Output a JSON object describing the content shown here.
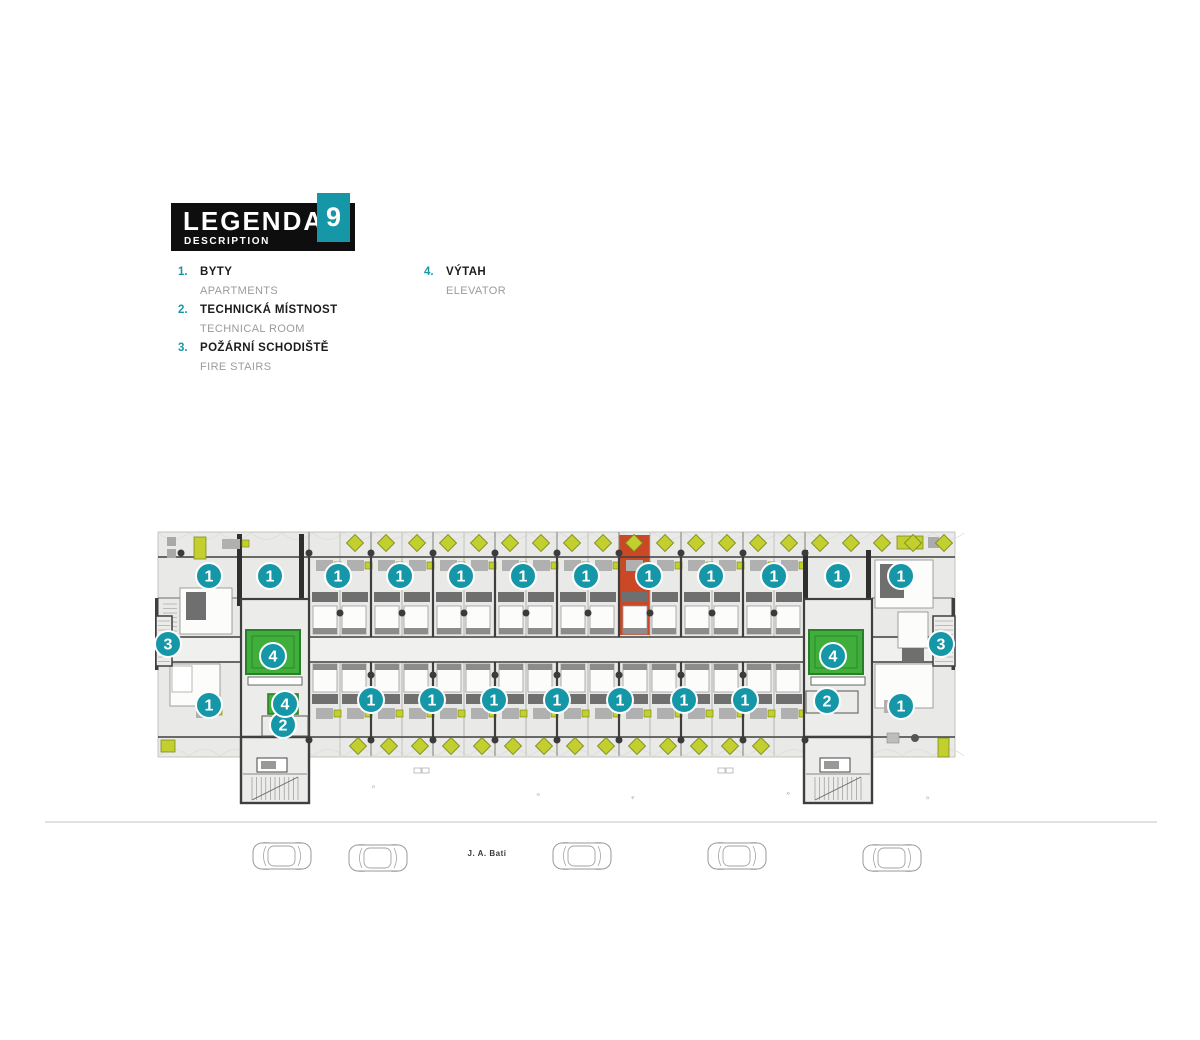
{
  "legend": {
    "title": "LEGENDA",
    "subtitle": "DESCRIPTION",
    "floor_number": "9",
    "items": [
      {
        "num": "1.",
        "label_cs": "BYTY",
        "label_en": "APARTMENTS"
      },
      {
        "num": "2.",
        "label_cs": "TECHNICKÁ MÍSTNOST",
        "label_en": "TECHNICAL ROOM"
      },
      {
        "num": "3.",
        "label_cs": "POŽÁRNÍ SCHODIŠTĚ",
        "label_en": "FIRE STAIRS"
      },
      {
        "num": "4.",
        "label_cs": "VÝTAH",
        "label_en": "ELEVATOR"
      }
    ]
  },
  "plan": {
    "colors": {
      "teal": "#1697a8",
      "green": "#3fae3b",
      "green_dark": "#2c7f2a",
      "red": "#cb4826",
      "furniture_yellow": "#c3cf2e",
      "furniture_yellow_dark": "#7d8d1f",
      "wall": "#3f3f3f",
      "floor": "#e9e9e7",
      "room": "#fcfcfb",
      "gray_block": "#6f6f6f",
      "gray_desk": "#b0b0b0",
      "road": "#cfcfcd",
      "car_outline": "#9a9a9a"
    },
    "markers": [
      {
        "n": "1",
        "x": 209,
        "y": 576
      },
      {
        "n": "1",
        "x": 270,
        "y": 576
      },
      {
        "n": "1",
        "x": 338,
        "y": 576
      },
      {
        "n": "1",
        "x": 400,
        "y": 576
      },
      {
        "n": "1",
        "x": 461,
        "y": 576
      },
      {
        "n": "1",
        "x": 523,
        "y": 576
      },
      {
        "n": "1",
        "x": 586,
        "y": 576
      },
      {
        "n": "1",
        "x": 649,
        "y": 576
      },
      {
        "n": "1",
        "x": 711,
        "y": 576
      },
      {
        "n": "1",
        "x": 774,
        "y": 576
      },
      {
        "n": "1",
        "x": 838,
        "y": 576
      },
      {
        "n": "1",
        "x": 901,
        "y": 576
      },
      {
        "n": "1",
        "x": 209,
        "y": 705
      },
      {
        "n": "1",
        "x": 371,
        "y": 700
      },
      {
        "n": "1",
        "x": 432,
        "y": 700
      },
      {
        "n": "1",
        "x": 494,
        "y": 700
      },
      {
        "n": "1",
        "x": 557,
        "y": 700
      },
      {
        "n": "1",
        "x": 620,
        "y": 700
      },
      {
        "n": "1",
        "x": 684,
        "y": 700
      },
      {
        "n": "1",
        "x": 745,
        "y": 700
      },
      {
        "n": "1",
        "x": 901,
        "y": 706
      },
      {
        "n": "2",
        "x": 283,
        "y": 725
      },
      {
        "n": "2",
        "x": 827,
        "y": 701
      },
      {
        "n": "3",
        "x": 168,
        "y": 644
      },
      {
        "n": "3",
        "x": 941,
        "y": 644
      },
      {
        "n": "4",
        "x": 273,
        "y": 656
      },
      {
        "n": "4",
        "x": 285,
        "y": 704
      },
      {
        "n": "4",
        "x": 833,
        "y": 656
      }
    ],
    "highlighted_unit": {
      "marker": "1",
      "x": 619,
      "y": 535,
      "w": 31,
      "h": 100
    }
  },
  "street": {
    "label": "J. A. Bati",
    "cars": [
      {
        "x": 253,
        "y": 843
      },
      {
        "x": 349,
        "y": 845
      },
      {
        "x": 553,
        "y": 843
      },
      {
        "x": 708,
        "y": 843
      },
      {
        "x": 863,
        "y": 845
      }
    ]
  }
}
